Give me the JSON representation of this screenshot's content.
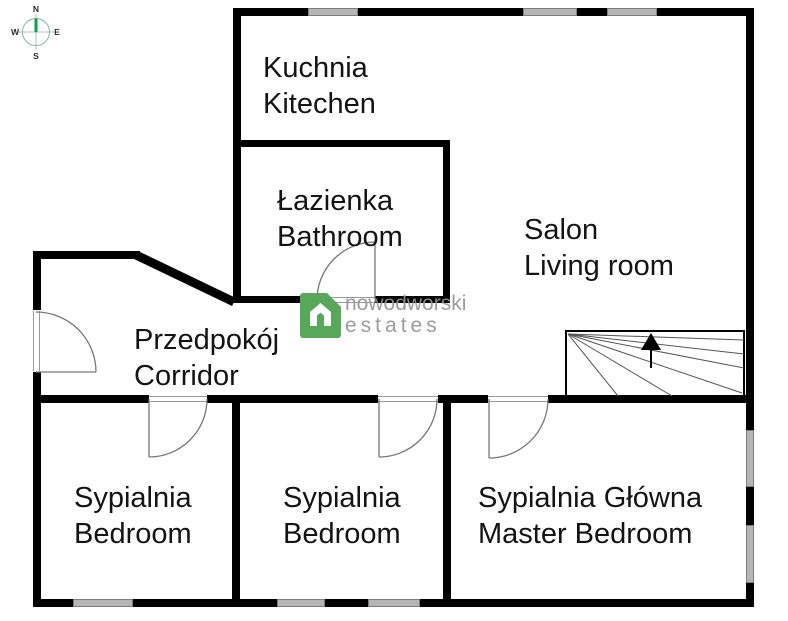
{
  "compass": {
    "north": "N",
    "south": "S",
    "east": "E",
    "west": "W",
    "needle_color": "#0aa04e",
    "ring_color": "#8ab5a1"
  },
  "rooms": [
    {
      "id": "kitchen",
      "name_pl": "Kuchnia",
      "name_en": "Kitechen"
    },
    {
      "id": "bathroom",
      "name_pl": "Łazienka",
      "name_en": "Bathroom"
    },
    {
      "id": "living-room",
      "name_pl": "Salon",
      "name_en": "Living room"
    },
    {
      "id": "corridor",
      "name_pl": "Przedpokój",
      "name_en": "Corridor"
    },
    {
      "id": "bedroom-1",
      "name_pl": "Sypialnia",
      "name_en": "Bedroom"
    },
    {
      "id": "bedroom-2",
      "name_pl": "Sypialnia",
      "name_en": "Bedroom"
    },
    {
      "id": "master-bedroom",
      "name_pl": "Sypialnia Główna",
      "name_en": "Master Bedroom"
    }
  ],
  "watermark": {
    "line1": "nowodworski",
    "line2": "estates",
    "accent_color": "#58a85a",
    "text_color": "#949494"
  },
  "colors": {
    "wall": "#000000",
    "window_fill": "#b5b5b5",
    "window_edge": "#7e7e7e",
    "door_line": "#777777"
  }
}
